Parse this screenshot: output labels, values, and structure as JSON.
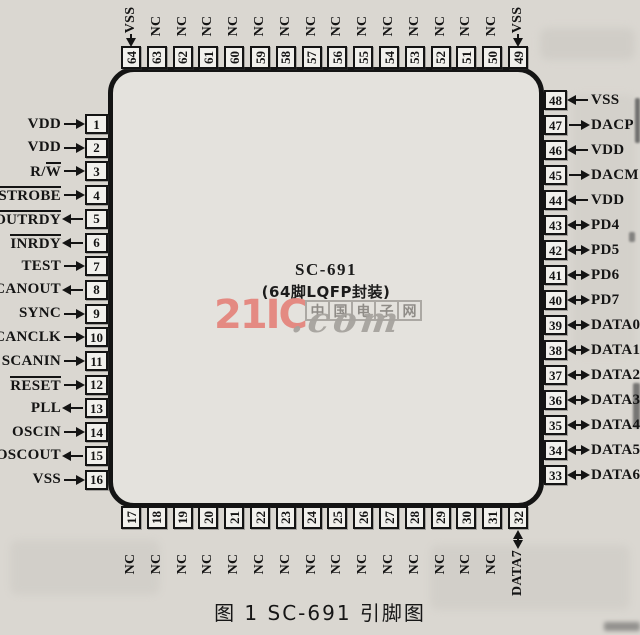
{
  "page": {
    "paper_color": "#dad7d1",
    "ink_color": "#141414"
  },
  "chip": {
    "name": "SC-691",
    "package": "(64脚LQFP封装)",
    "fill_color": "#e4e2dd",
    "box_fill_color": "#f1f0ec"
  },
  "caption": "图 1  SC-691 引脚图",
  "watermark": {
    "brand": "21IC",
    "suffix": ".com",
    "site": "中国电子网",
    "brand_color": "#e5837b",
    "gray_color": "#a6a39e"
  },
  "pins": {
    "left": [
      {
        "num": "1",
        "pre": "VDD",
        "ol": "",
        "dir": "in"
      },
      {
        "num": "2",
        "pre": "VDD",
        "ol": "",
        "dir": "in"
      },
      {
        "num": "3",
        "pre": "R/",
        "ol": "W",
        "dir": "in"
      },
      {
        "num": "4",
        "pre": "",
        "ol": "STROBE",
        "dir": "in"
      },
      {
        "num": "5",
        "pre": "",
        "ol": "OUTRDY",
        "dir": "out"
      },
      {
        "num": "6",
        "pre": "",
        "ol": "INRDY",
        "dir": "out"
      },
      {
        "num": "7",
        "pre": "TEST",
        "ol": "",
        "dir": "in"
      },
      {
        "num": "8",
        "pre": "SCANOUT",
        "ol": "",
        "dir": "out"
      },
      {
        "num": "9",
        "pre": "SYNC",
        "ol": "",
        "dir": "in"
      },
      {
        "num": "10",
        "pre": "SCANCLK",
        "ol": "",
        "dir": "in"
      },
      {
        "num": "11",
        "pre": "SCANIN",
        "ol": "",
        "dir": "in"
      },
      {
        "num": "12",
        "pre": "",
        "ol": "RESET",
        "dir": "in"
      },
      {
        "num": "13",
        "pre": "PLL",
        "ol": "",
        "dir": "out"
      },
      {
        "num": "14",
        "pre": "OSCIN",
        "ol": "",
        "dir": "in"
      },
      {
        "num": "15",
        "pre": "OSCOUT",
        "ol": "",
        "dir": "out"
      },
      {
        "num": "16",
        "pre": "VSS",
        "ol": "",
        "dir": "in"
      }
    ],
    "right": [
      {
        "num": "48",
        "pre": "VSS",
        "ol": "",
        "dir": "in"
      },
      {
        "num": "47",
        "pre": "DACP",
        "ol": "",
        "dir": "out"
      },
      {
        "num": "46",
        "pre": "VDD",
        "ol": "",
        "dir": "in"
      },
      {
        "num": "45",
        "pre": "DACM",
        "ol": "",
        "dir": "out"
      },
      {
        "num": "44",
        "pre": "VDD",
        "ol": "",
        "dir": "in"
      },
      {
        "num": "43",
        "pre": "PD4",
        "ol": "",
        "dir": "bi"
      },
      {
        "num": "42",
        "pre": "PD5",
        "ol": "",
        "dir": "bi"
      },
      {
        "num": "41",
        "pre": "PD6",
        "ol": "",
        "dir": "bi"
      },
      {
        "num": "40",
        "pre": "PD7",
        "ol": "",
        "dir": "bi"
      },
      {
        "num": "39",
        "pre": "DATA0",
        "ol": "",
        "dir": "bi"
      },
      {
        "num": "38",
        "pre": "DATA1",
        "ol": "",
        "dir": "bi"
      },
      {
        "num": "37",
        "pre": "DATA2",
        "ol": "",
        "dir": "bi"
      },
      {
        "num": "36",
        "pre": "DATA3",
        "ol": "",
        "dir": "bi"
      },
      {
        "num": "35",
        "pre": "DATA4",
        "ol": "",
        "dir": "bi"
      },
      {
        "num": "34",
        "pre": "DATA5",
        "ol": "",
        "dir": "bi"
      },
      {
        "num": "33",
        "pre": "DATA6",
        "ol": "",
        "dir": "bi"
      }
    ],
    "top": [
      {
        "num": "64",
        "label": "VSS",
        "dir": "in"
      },
      {
        "num": "63",
        "label": "NC",
        "dir": "none"
      },
      {
        "num": "62",
        "label": "NC",
        "dir": "none"
      },
      {
        "num": "61",
        "label": "NC",
        "dir": "none"
      },
      {
        "num": "60",
        "label": "NC",
        "dir": "none"
      },
      {
        "num": "59",
        "label": "NC",
        "dir": "none"
      },
      {
        "num": "58",
        "label": "NC",
        "dir": "none"
      },
      {
        "num": "57",
        "label": "NC",
        "dir": "none"
      },
      {
        "num": "56",
        "label": "NC",
        "dir": "none"
      },
      {
        "num": "55",
        "label": "NC",
        "dir": "none"
      },
      {
        "num": "54",
        "label": "NC",
        "dir": "none"
      },
      {
        "num": "53",
        "label": "NC",
        "dir": "none"
      },
      {
        "num": "52",
        "label": "NC",
        "dir": "none"
      },
      {
        "num": "51",
        "label": "NC",
        "dir": "none"
      },
      {
        "num": "50",
        "label": "NC",
        "dir": "none"
      },
      {
        "num": "49",
        "label": "VSS",
        "dir": "in"
      }
    ],
    "bottom": [
      {
        "num": "17",
        "label": "NC",
        "dir": "none"
      },
      {
        "num": "18",
        "label": "NC",
        "dir": "none"
      },
      {
        "num": "19",
        "label": "NC",
        "dir": "none"
      },
      {
        "num": "20",
        "label": "NC",
        "dir": "none"
      },
      {
        "num": "21",
        "label": "NC",
        "dir": "none"
      },
      {
        "num": "22",
        "label": "NC",
        "dir": "none"
      },
      {
        "num": "23",
        "label": "NC",
        "dir": "none"
      },
      {
        "num": "24",
        "label": "NC",
        "dir": "none"
      },
      {
        "num": "25",
        "label": "NC",
        "dir": "none"
      },
      {
        "num": "26",
        "label": "NC",
        "dir": "none"
      },
      {
        "num": "27",
        "label": "NC",
        "dir": "none"
      },
      {
        "num": "28",
        "label": "NC",
        "dir": "none"
      },
      {
        "num": "29",
        "label": "NC",
        "dir": "none"
      },
      {
        "num": "30",
        "label": "NC",
        "dir": "none"
      },
      {
        "num": "31",
        "label": "NC",
        "dir": "none"
      },
      {
        "num": "32",
        "label": "DATA7",
        "dir": "bi"
      }
    ]
  }
}
